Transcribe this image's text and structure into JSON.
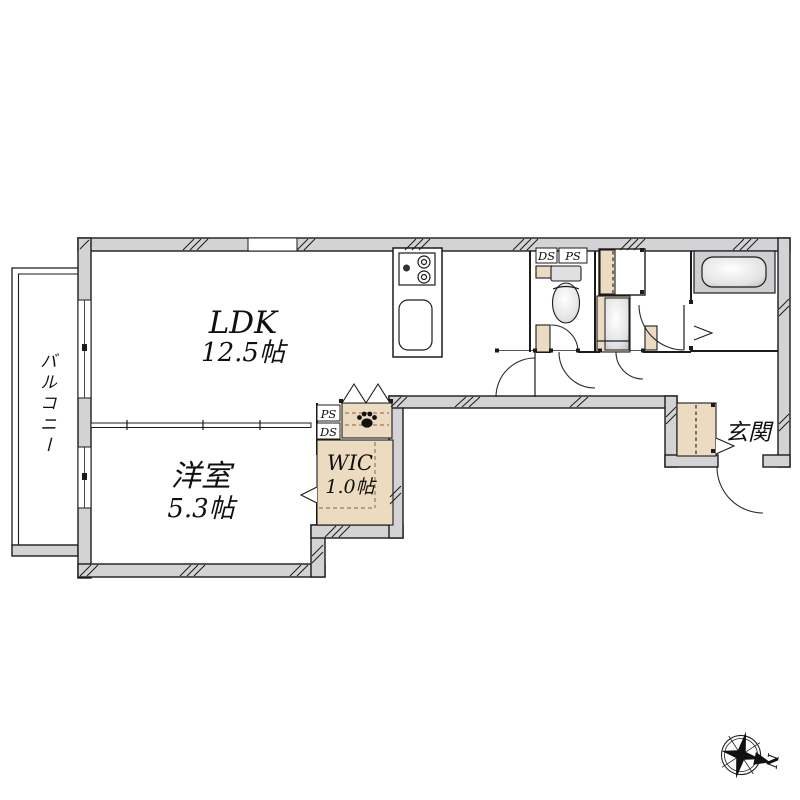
{
  "floorplan": {
    "rooms": {
      "ldk": {
        "label": "LDK",
        "area": "12.5帖"
      },
      "bedroom": {
        "label": "洋室",
        "area": "5.3帖"
      },
      "wic": {
        "label": "WIC",
        "area": "1.0帖"
      },
      "balcony": {
        "label": "バルコニー"
      },
      "entrance": {
        "label": "玄関"
      }
    },
    "shafts": {
      "toilet_ds": "DS",
      "toilet_ps": "PS",
      "closet_ps": "PS",
      "closet_ds": "DS"
    },
    "compass": {
      "north": "N"
    },
    "colors": {
      "wall_gray": "#d3d3d5",
      "closet_beige": "#ecdbc0",
      "dash_tan": "#9a7b52",
      "fixture_gray": "#c9c9cc",
      "line_black": "#1b1b1b"
    }
  }
}
